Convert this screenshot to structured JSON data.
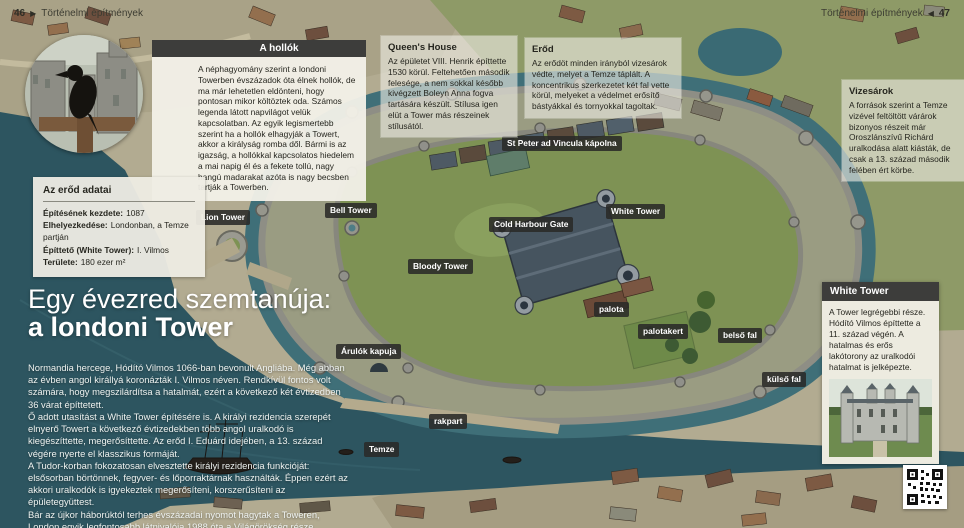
{
  "page": {
    "header_left": {
      "page_number": "46",
      "arrow": "▶",
      "title": "Történelmi építmények"
    },
    "header_right": {
      "title": "Történelmi építmények",
      "arrow": "◀",
      "page_number": "47"
    }
  },
  "main": {
    "title_line1": "Egy évezred szemtanúja:",
    "title_line2": "a londoni Tower",
    "paragraphs": [
      "Normandia hercege, Hódító Vilmos 1066-ban bevonult Angliába. Még abban az évben angol királlyá koronázták I. Vilmos néven. Rendkívül fontos volt számára, hogy megszilárdítsa a hatalmát, ezért a következő két évtizedben 36 várat építtetett.",
      "Ő adott utasítást a White Tower építésére is. A királyi rezidencia szerepét elnyerő Towert a következő évtizedekben több angol uralkodó is kiegészíttette, megerősíttette. Az erőd I. Eduárd idejében, a 13. század végére nyerte el klasszikus formáját.",
      "A Tudor-korban fokozatosan elvesztette királyi rezidencia funkcióját: elsősorban börtönnek, fegyver- és lőporraktárnak használták. Éppen ezért az akkori uralkodók is igyekeztek megerősíteni, korszerűsíteni az épületegyüttest.",
      "Bár az újkor háborúktól terhes évszázadai nyomot hagytak a Toweren, London egyik legfontosabb látnivalója 1988 óta a Világörökség része."
    ]
  },
  "callouts": {
    "ravens": {
      "title": "A hollók",
      "body": "A néphagyomány szerint a londoni Towerben évszázadok óta élnek hollók, de ma már lehetetlen eldönteni, hogy pontosan mikor költöztek oda. Számos legenda látott napvilágot velük kapcsolatban. Az egyik legismertebb szerint ha a hollók elhagyják a Towert, akkor a királyság romba dől. Bármi is az igazság, a hollókkal kapcsolatos hiedelem a mai napig él és a fekete tollú, nagy hangú madarakat azóta is nagy becsben tartják a Towerben."
    },
    "queens_house": {
      "title": "Queen's House",
      "body": "Az épületet VIII. Henrik építtette 1530 körül. Feltehetően második felesége, a nem sokkal később kivégzett Boleyn Anna fogva tartására készült. Stílusa igen elüt a Tower más részeinek stílusától."
    },
    "erod": {
      "title": "Erőd",
      "body": "Az erődöt minden irányból vizesárok védte, melyet a Temze táplált. A koncentrikus szerkezetet két fal vette körül, melyeket a védelmet erősítő bástyákkal és tornyokkal tagoltak."
    },
    "vizesarok": {
      "title": "Vizesárok",
      "body": "A források szerint a Temze vizével feltöltött várárok bizonyos részeit már Oroszlánszívű Richárd uralkodása alatt kiásták, de csak a 13. század második felében ért körbe."
    },
    "white_tower": {
      "title": "White Tower",
      "body": "A Tower legrégebbi része. Hódító Vilmos építtette a 11. század végén. A hatalmas és erős lakótorony az uralkodói hatalmat is jelképezte."
    }
  },
  "fact_box": {
    "title": "Az erőd adatai",
    "rows": [
      {
        "label": "Építésének kezdete:",
        "value": "1087"
      },
      {
        "label": "Elhelyezkedése:",
        "value": "Londonban, a Temze partján"
      },
      {
        "label": "Építtető (White Tower):",
        "value": "I. Vilmos"
      },
      {
        "label": "Területe:",
        "value": "180 ezer m²"
      }
    ]
  },
  "map_labels": [
    {
      "id": "st-peter",
      "text": "St Peter ad Vincula kápolna"
    },
    {
      "id": "lion-tower",
      "text": "Lion Tower"
    },
    {
      "id": "bell-tower",
      "text": "Bell Tower"
    },
    {
      "id": "white-tower",
      "text": "White Tower"
    },
    {
      "id": "cold-harbour",
      "text": "Cold Harbour Gate"
    },
    {
      "id": "bloody-tower",
      "text": "Bloody Tower"
    },
    {
      "id": "palota",
      "text": "palota"
    },
    {
      "id": "palotakert",
      "text": "palotakert"
    },
    {
      "id": "belso-fal",
      "text": "belső fal"
    },
    {
      "id": "kulso-fal",
      "text": "külső fal"
    },
    {
      "id": "arulok-kapuja",
      "text": "Árulók kapuja"
    },
    {
      "id": "rakpart",
      "text": "rakpart"
    },
    {
      "id": "temze",
      "text": "Temze"
    }
  ],
  "colors": {
    "water": "#2d5560",
    "moat": "#3f6f78",
    "label_bg": "#2a2a28",
    "panel_bg": "#edebe1",
    "title_bar": "#3d3d3b"
  }
}
